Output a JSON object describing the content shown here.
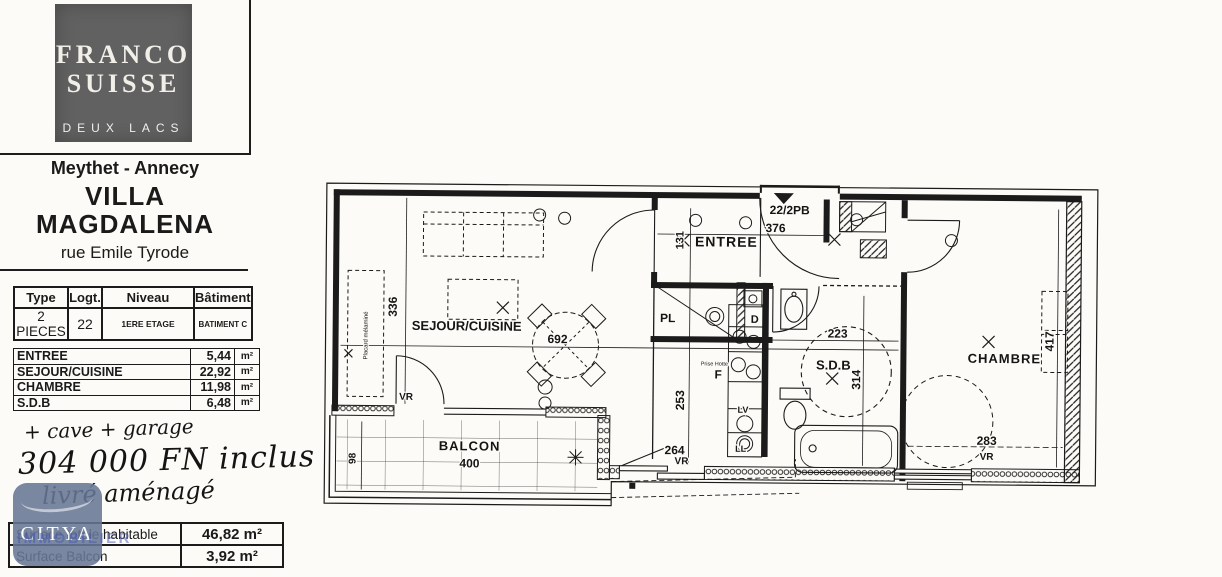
{
  "colors": {
    "paper": "#fcfbf7",
    "ink": "#1b1b1b",
    "logo_bg": "#616161",
    "citya_badge": "#687695",
    "citya_sub": "#4255b8"
  },
  "sidebar": {
    "logo": {
      "line1": "FRANCO",
      "line2": "SUISSE",
      "line3": "DEUX LACS"
    },
    "location": "Meythet - Annecy",
    "title_line1": "VILLA",
    "title_line2": "MAGDALENA",
    "street": "rue Emile Tyrode",
    "info_table": {
      "headers": [
        "Type",
        "Logt.",
        "Niveau",
        "Bâtiment"
      ],
      "row": [
        "2 PIECES",
        "22",
        "1ERE ETAGE",
        "BATIMENT C"
      ]
    },
    "areas_table": {
      "rows": [
        {
          "name": "ENTREE",
          "value": "5,44",
          "unit": "m²"
        },
        {
          "name": "SEJOUR/CUISINE",
          "value": "22,92",
          "unit": "m²"
        },
        {
          "name": "CHAMBRE",
          "value": "11,98",
          "unit": "m²"
        },
        {
          "name": "S.D.B",
          "value": "6,48",
          "unit": "m²"
        }
      ]
    },
    "handwritten_notes": [
      "+ cave + garage",
      "304 000 FN inclus",
      "livré aménagé"
    ],
    "agency": {
      "name": "CITYA",
      "subtitle": "IMMOBILIER"
    },
    "totals_table": {
      "rows": [
        {
          "label": "Surface totale habitable",
          "value": "46,82 m²"
        },
        {
          "label": "Surface Balcon",
          "value": "3,92 m²"
        }
      ]
    }
  },
  "plan": {
    "texts": [
      {
        "id": "label-sejour-cuisine",
        "t": "SEJOUR/CUISINE",
        "x": 156,
        "y": 156,
        "s": 13
      },
      {
        "id": "dim-692",
        "t": "692",
        "x": 247,
        "y": 168,
        "s": 12
      },
      {
        "id": "dim-336",
        "t": "336",
        "x": 86,
        "y": 133,
        "s": 12,
        "r": -90
      },
      {
        "id": "label-entree",
        "t": "ENTREE",
        "x": 415,
        "y": 70,
        "s": 14,
        "ls": 1
      },
      {
        "id": "dim-131",
        "t": "131",
        "x": 372,
        "y": 64,
        "s": 11,
        "r": -90
      },
      {
        "id": "dim-376",
        "t": "376",
        "x": 464,
        "y": 55,
        "s": 12
      },
      {
        "id": "label-unit-number",
        "t": "22/2PB",
        "x": 478,
        "y": 37,
        "s": 12
      },
      {
        "id": "label-pl",
        "t": "PL",
        "x": 357,
        "y": 146,
        "s": 12
      },
      {
        "id": "label-d",
        "t": "D",
        "x": 444,
        "y": 146,
        "s": 11
      },
      {
        "id": "label-prise-hotte",
        "t": "Prise Hotte",
        "x": 404,
        "y": 189,
        "s": 5.5,
        "w": 400
      },
      {
        "id": "label-f",
        "t": "F",
        "x": 408,
        "y": 202,
        "s": 12
      },
      {
        "id": "label-lv",
        "t": "LV",
        "x": 433,
        "y": 236,
        "s": 9
      },
      {
        "id": "label-ll",
        "t": "LL",
        "x": 431,
        "y": 275,
        "s": 9
      },
      {
        "id": "label-sdb",
        "t": "S.D.B",
        "x": 523,
        "y": 192,
        "s": 13
      },
      {
        "id": "dim-223",
        "t": "223",
        "x": 527,
        "y": 160,
        "s": 12
      },
      {
        "id": "dim-314",
        "t": "314",
        "x": 550,
        "y": 202,
        "s": 12,
        "r": -90
      },
      {
        "id": "dim-253",
        "t": "253",
        "x": 374,
        "y": 224,
        "s": 12,
        "r": -90
      },
      {
        "id": "dim-264",
        "t": "264",
        "x": 365,
        "y": 278,
        "s": 12
      },
      {
        "id": "label-vr-sejour",
        "t": "VR",
        "x": 96,
        "y": 226,
        "s": 10
      },
      {
        "id": "label-vr-cuisine",
        "t": "VR",
        "x": 372,
        "y": 288,
        "s": 10
      },
      {
        "id": "label-vr-chambre",
        "t": "VR",
        "x": 677,
        "y": 281,
        "s": 10
      },
      {
        "id": "label-chambre",
        "t": "CHAMBRE",
        "x": 694,
        "y": 184,
        "s": 13,
        "ls": 1
      },
      {
        "id": "dim-417",
        "t": "417",
        "x": 743,
        "y": 162,
        "s": 12,
        "r": -90
      },
      {
        "id": "dim-283",
        "t": "283",
        "x": 677,
        "y": 266,
        "s": 12
      },
      {
        "id": "label-balcon",
        "t": "BALCON",
        "x": 160,
        "y": 276,
        "s": 13,
        "ls": 1
      },
      {
        "id": "dim-400",
        "t": "400",
        "x": 160,
        "y": 293,
        "s": 12
      },
      {
        "id": "dim-98",
        "t": "98",
        "x": 46,
        "y": 285,
        "s": 10,
        "r": -90
      },
      {
        "id": "label-placard",
        "t": "Placard mélaminé",
        "x": 57,
        "y": 162,
        "s": 6,
        "w": 400,
        "r": -90
      }
    ]
  }
}
